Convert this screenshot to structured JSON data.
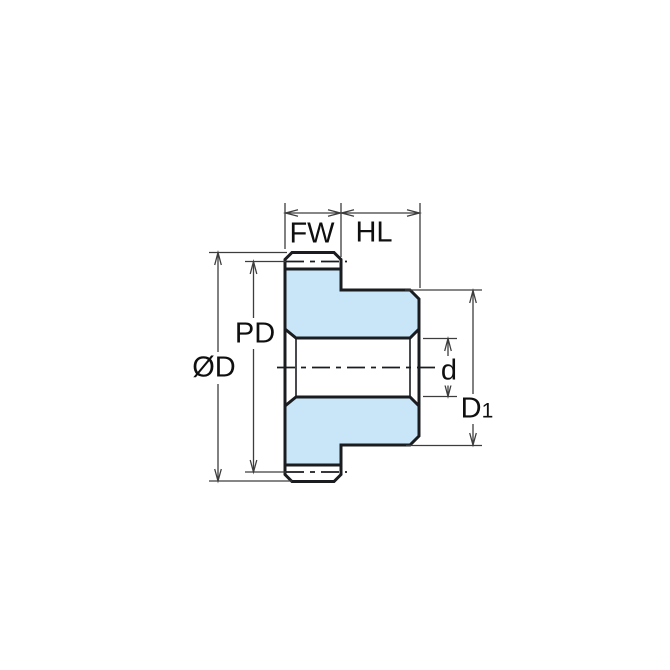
{
  "colors": {
    "background": "#FFFFFF",
    "part_fill": "#C8E6F8",
    "outline": "#1A1C20",
    "dim": "#3D3D3D",
    "label": "#0F0F0F"
  },
  "labels": {
    "face_width": "FW",
    "hub_length": "HL",
    "pitch_diameter": "PD",
    "outer_diameter": "ØD",
    "bore_diameter": "d",
    "hub_diameter_base": "D",
    "hub_diameter_sub": "1"
  }
}
